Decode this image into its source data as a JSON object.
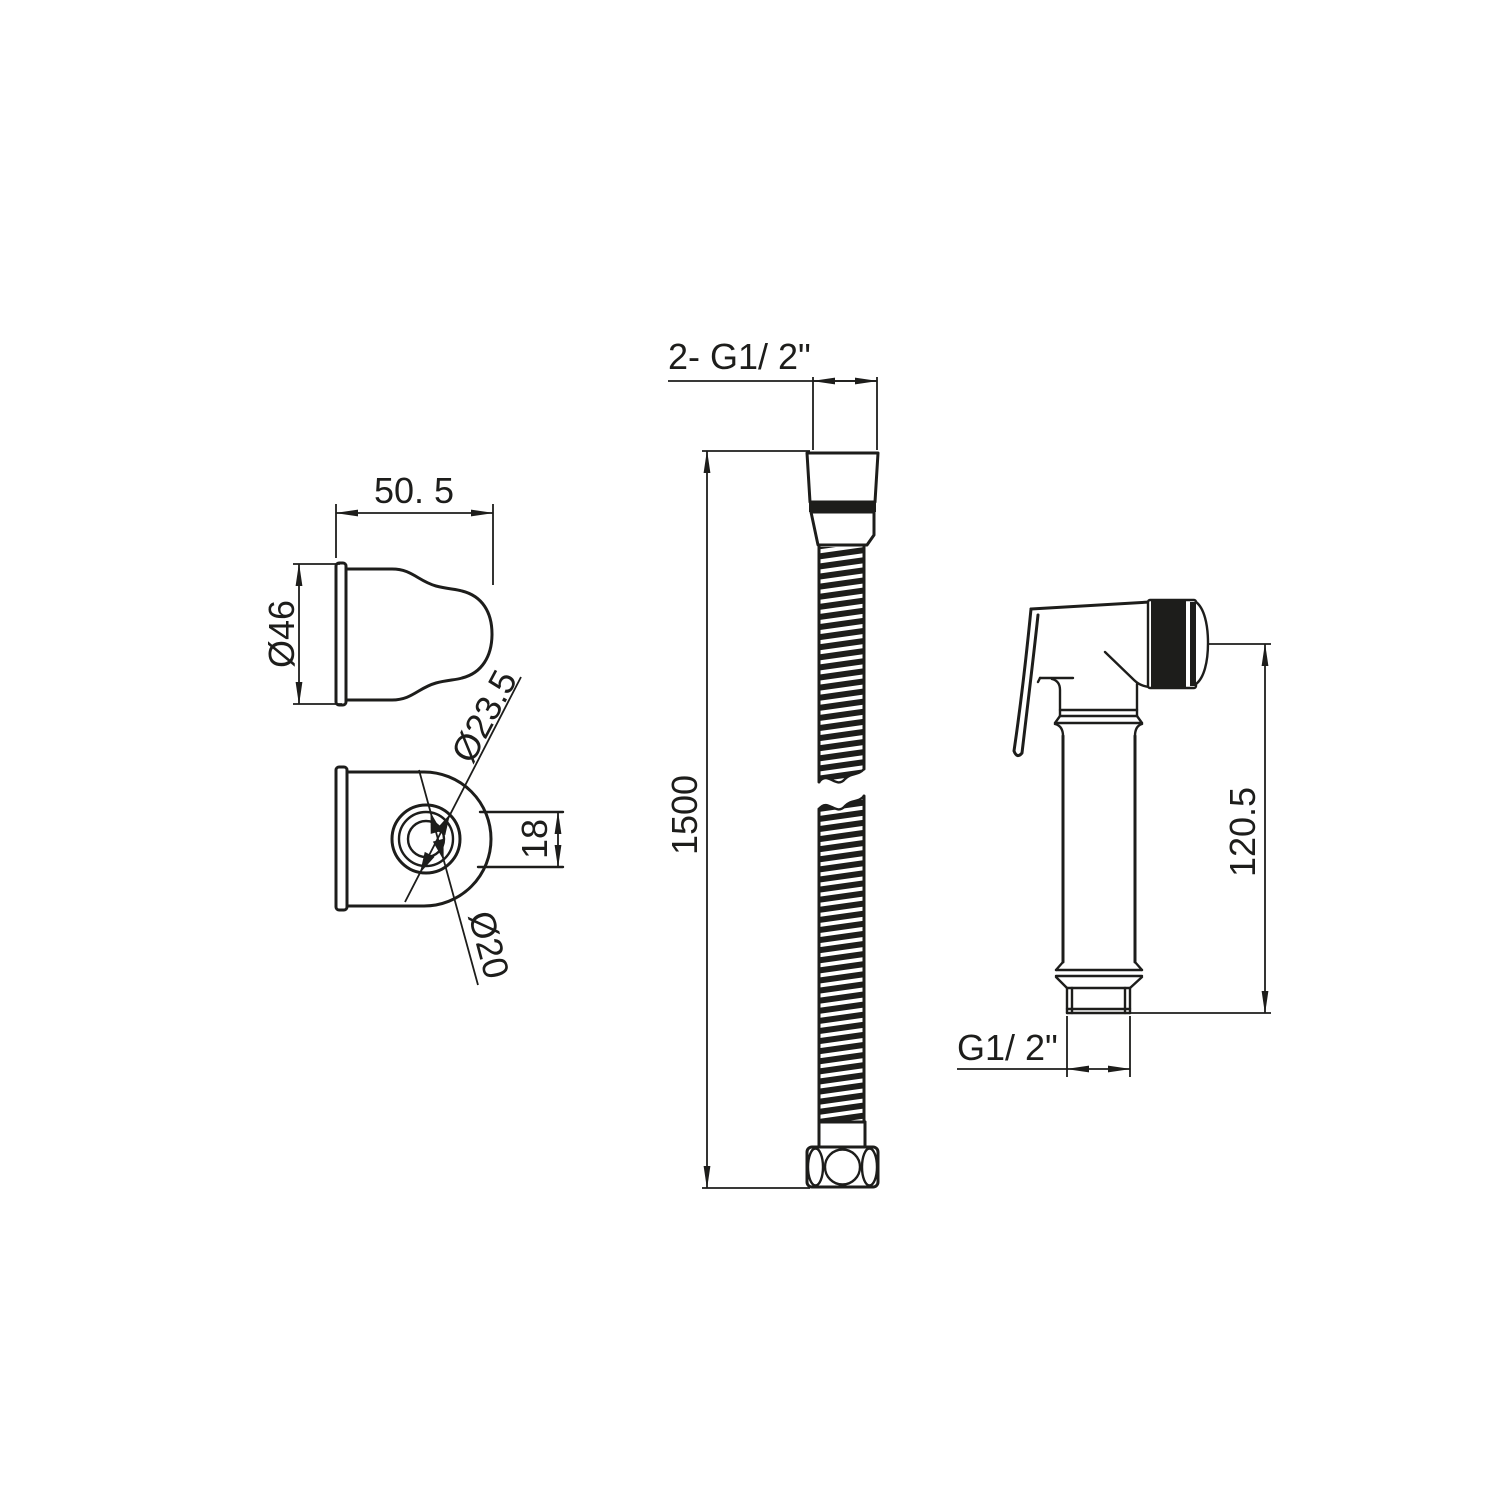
{
  "drawing": {
    "background_color": "#ffffff",
    "line_color": "#1d1d1b",
    "labels": {
      "bracket_width": "50. 5",
      "bracket_diameter": "Ø46",
      "holder_ring_diameter": "Ø23.5",
      "holder_slot_height": "18",
      "holder_bore_diameter": "Ø20",
      "hose_thread": "2- G1/ 2\"",
      "hose_length": "1500",
      "sprayer_height": "120.5",
      "sprayer_thread": "G1/ 2\""
    }
  }
}
